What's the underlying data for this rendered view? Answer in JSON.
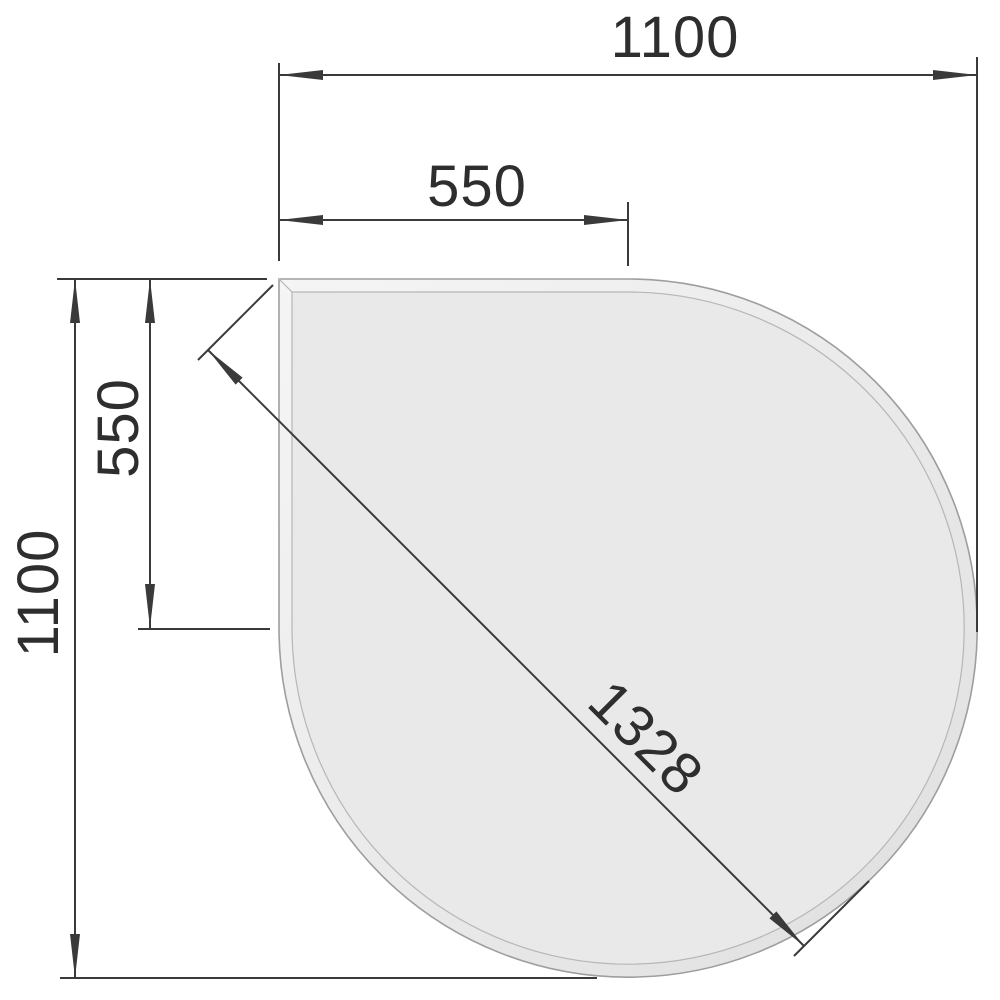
{
  "drawing": {
    "kind": "teardrop-plate-dimension-drawing",
    "dimensions": {
      "width_total": "1100",
      "width_to_tangent": "550",
      "height_to_tangent": "550",
      "height_total": "1100",
      "diagonal_max": "1328"
    },
    "colors": {
      "line": "#3a3a3a",
      "text": "#2e2e2e",
      "background": "#ffffff",
      "face_fill": "#e9e9e9",
      "bevel_light": "#f5f5f5",
      "bevel_dark": "#dfdfdf",
      "outline_outer": "#9e9e9e",
      "outline_inner": "#b6b6b6"
    }
  }
}
